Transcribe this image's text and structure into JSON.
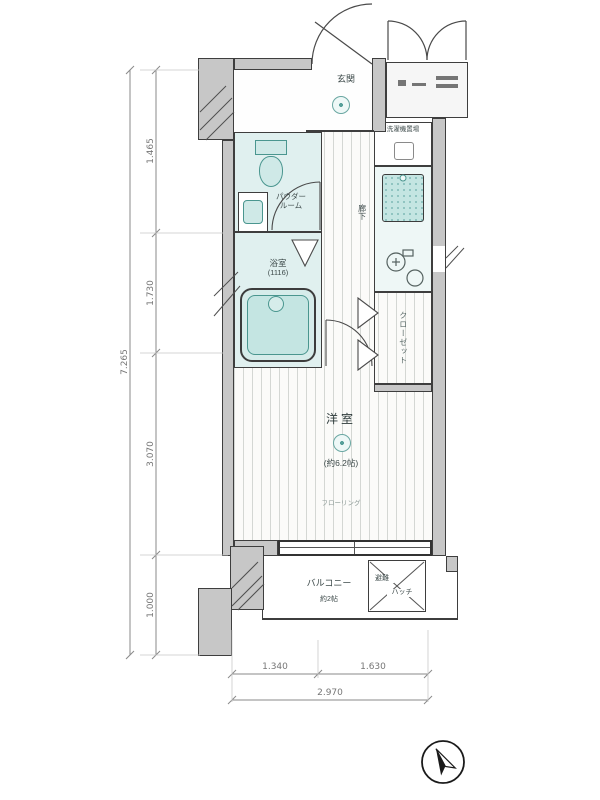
{
  "rooms": {
    "entrance": {
      "label": "玄関"
    },
    "powder": {
      "line1": "パウダー",
      "line2": "ルーム"
    },
    "bath": {
      "name": "浴室",
      "size": "(1116)"
    },
    "hall": {
      "label": "廊下"
    },
    "washer": {
      "label": "洗濯機置場"
    },
    "closet": {
      "label": "クローゼット"
    },
    "room": {
      "name": "洋室",
      "size": "(約6.2帖)",
      "floor": "フローリング"
    },
    "balcony": {
      "name": "バルコニー",
      "size": "約2帖"
    },
    "hatch": {
      "line1": "避難",
      "line2": "ハッチ"
    }
  },
  "dimensions": {
    "left": {
      "total": "7.265",
      "segments": [
        "1.465",
        "1.730",
        "3.070",
        "1.000"
      ]
    },
    "bottom": {
      "total": "2.970",
      "segments": [
        "1.340",
        "1.630"
      ]
    }
  },
  "colors": {
    "wall_fill": "#c7c7c7",
    "wet_room": "#e0f0ef",
    "fixture_fill": "#cfe9e7",
    "fixture_border": "#4a968f",
    "outline": "#3e3e3e",
    "dimension_text": "#767676"
  }
}
